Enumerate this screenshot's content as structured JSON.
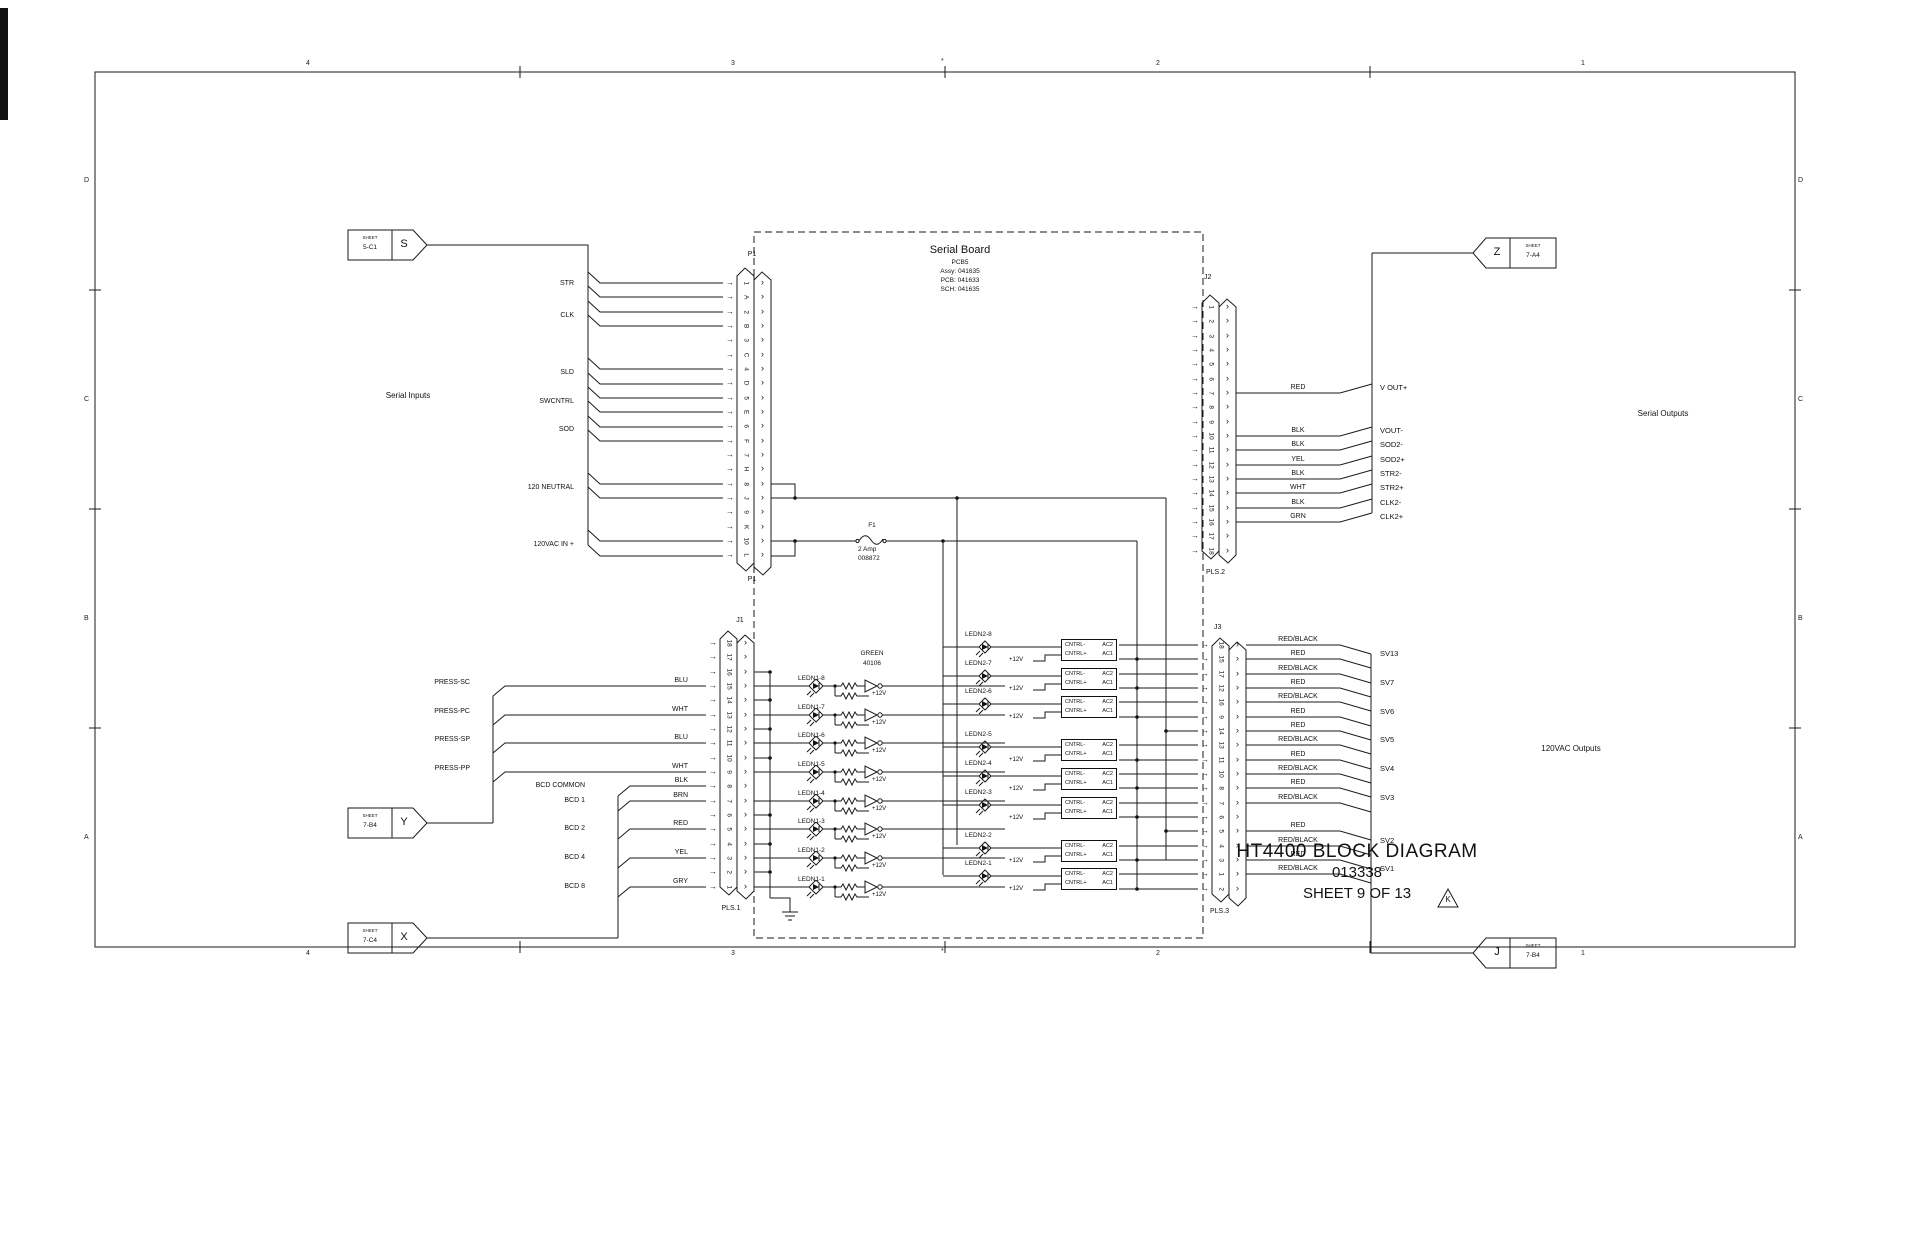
{
  "titleblock": {
    "line1": "HT4400 BLOCK DIAGRAM",
    "line2": "013338",
    "line3": "SHEET 9 OF 13",
    "revision": "K"
  },
  "border": {
    "cols": [
      "4",
      "3",
      "2",
      "1"
    ],
    "rows": [
      "D",
      "C",
      "B",
      "A"
    ],
    "center_mark": "*"
  },
  "serial_board": {
    "title": "Serial Board",
    "lines": [
      "PCB5",
      "Assy: 041635",
      "PCB: 041633",
      "SCH: 041635"
    ]
  },
  "fuse": {
    "ref": "F1",
    "rating": "2 Amp",
    "part": "008872"
  },
  "section_labels": {
    "serial_inputs": "Serial Inputs",
    "serial_outputs": "Serial Outputs",
    "vac_outputs": "120VAC Outputs"
  },
  "offsheet": {
    "s": {
      "sheet_label": "SHEET",
      "ref": "5-C1",
      "letter": "S"
    },
    "y": {
      "sheet_label": "SHEET",
      "ref": "7-B4",
      "letter": "Y"
    },
    "x": {
      "sheet_label": "SHEET",
      "ref": "7-C4",
      "letter": "X"
    },
    "z": {
      "sheet_label": "SHEET",
      "ref": "7-A4",
      "letter": "Z"
    },
    "j": {
      "sheet_label": "SHEET",
      "ref": "7-B4",
      "letter": "J"
    }
  },
  "left_signals": [
    "STR",
    "CLK",
    "SLD",
    "SWCNTRL",
    "SOD",
    "120 NEUTRAL",
    "120VAC IN +"
  ],
  "press_signals": [
    "PRESS-SC",
    "PRESS-PC",
    "PRESS-SP",
    "PRESS-PP"
  ],
  "bcd_signals": [
    "BCD COMMON",
    "BCD 1",
    "BCD 2",
    "BCD 4",
    "BCD 8"
  ],
  "connectors": {
    "p1": {
      "name": "P1",
      "pins": [
        "1",
        "A",
        "2",
        "B",
        "3",
        "C",
        "4",
        "D",
        "5",
        "E",
        "6",
        "F",
        "7",
        "H",
        "8",
        "J",
        "9",
        "K",
        "10",
        "L"
      ]
    },
    "j1": {
      "name": "J1",
      "plug": "PLS.1",
      "pins": [
        "18",
        "17",
        "16",
        "15",
        "14",
        "13",
        "12",
        "11",
        "10",
        "9",
        "8",
        "7",
        "6",
        "5",
        "4",
        "3",
        "2",
        "1"
      ],
      "wire_colors": [
        "",
        "",
        "",
        "BLU",
        "",
        "WHT",
        "",
        "BLU",
        "",
        "WHT",
        "BLK",
        "BRN",
        "",
        "RED",
        "",
        "YEL",
        "",
        "GRY"
      ]
    },
    "j2": {
      "name": "J2",
      "plug": "PLS.2",
      "pins": [
        "1",
        "2",
        "3",
        "4",
        "5",
        "6",
        "7",
        "8",
        "9",
        "10",
        "11",
        "12",
        "13",
        "14",
        "15",
        "16",
        "17",
        "18"
      ],
      "wire_colors": [
        "",
        "",
        "",
        "",
        "",
        "",
        "RED",
        "",
        "",
        "BLK",
        "BLK",
        "YEL",
        "BLK",
        "WHT",
        "BLK",
        "GRN",
        "",
        ""
      ],
      "signals": [
        "",
        "",
        "",
        "",
        "",
        "",
        "V OUT+",
        "",
        "",
        "VOUT-",
        "SOD2-",
        "SOD2+",
        "STR2-",
        "STR2+",
        "CLK2-",
        "CLK2+",
        "",
        ""
      ]
    },
    "j3": {
      "name": "J3",
      "plug": "PLS.3",
      "pins": [
        "18",
        "15",
        "17",
        "12",
        "16",
        "9",
        "14",
        "13",
        "11",
        "10",
        "8",
        "7",
        "6",
        "5",
        "4",
        "3",
        "1",
        "2"
      ],
      "wire_colors": [
        "RED/BLACK",
        "RED",
        "RED/BLACK",
        "RED",
        "RED/BLACK",
        "RED",
        "RED",
        "RED/BLACK",
        "RED",
        "RED/BLACK",
        "RED",
        "RED/BLACK",
        "",
        "RED",
        "RED/BLACK",
        "RED",
        "RED/BLACK",
        ""
      ],
      "signals": [
        "",
        "SV13",
        "",
        "SV7",
        "",
        "SV6",
        "",
        "SV5",
        "",
        "SV4",
        "",
        "SV3",
        "",
        "",
        "SV2",
        "",
        "SV1",
        ""
      ]
    }
  },
  "led_bank1": {
    "chip_label": "GREEN",
    "chip_part": "40106",
    "supply": "+12V",
    "rows": [
      "LEDN1-8",
      "LEDN1-7",
      "LEDN1-6",
      "LEDN1-5",
      "LEDN1-4",
      "LEDN1-3",
      "LEDN1-2",
      "LEDN1-1"
    ]
  },
  "led_bank2": {
    "supply": "+12V",
    "box": {
      "tl": "CNTRL-",
      "tr": "AC2",
      "bl": "CNTRL+",
      "br": "AC1"
    },
    "rows": [
      "LEDN2-8",
      "LEDN2-7",
      "LEDN2-6",
      "LEDN2-5",
      "LEDN2-4",
      "LEDN2-3",
      "LEDN2-2",
      "LEDN2-1"
    ]
  }
}
